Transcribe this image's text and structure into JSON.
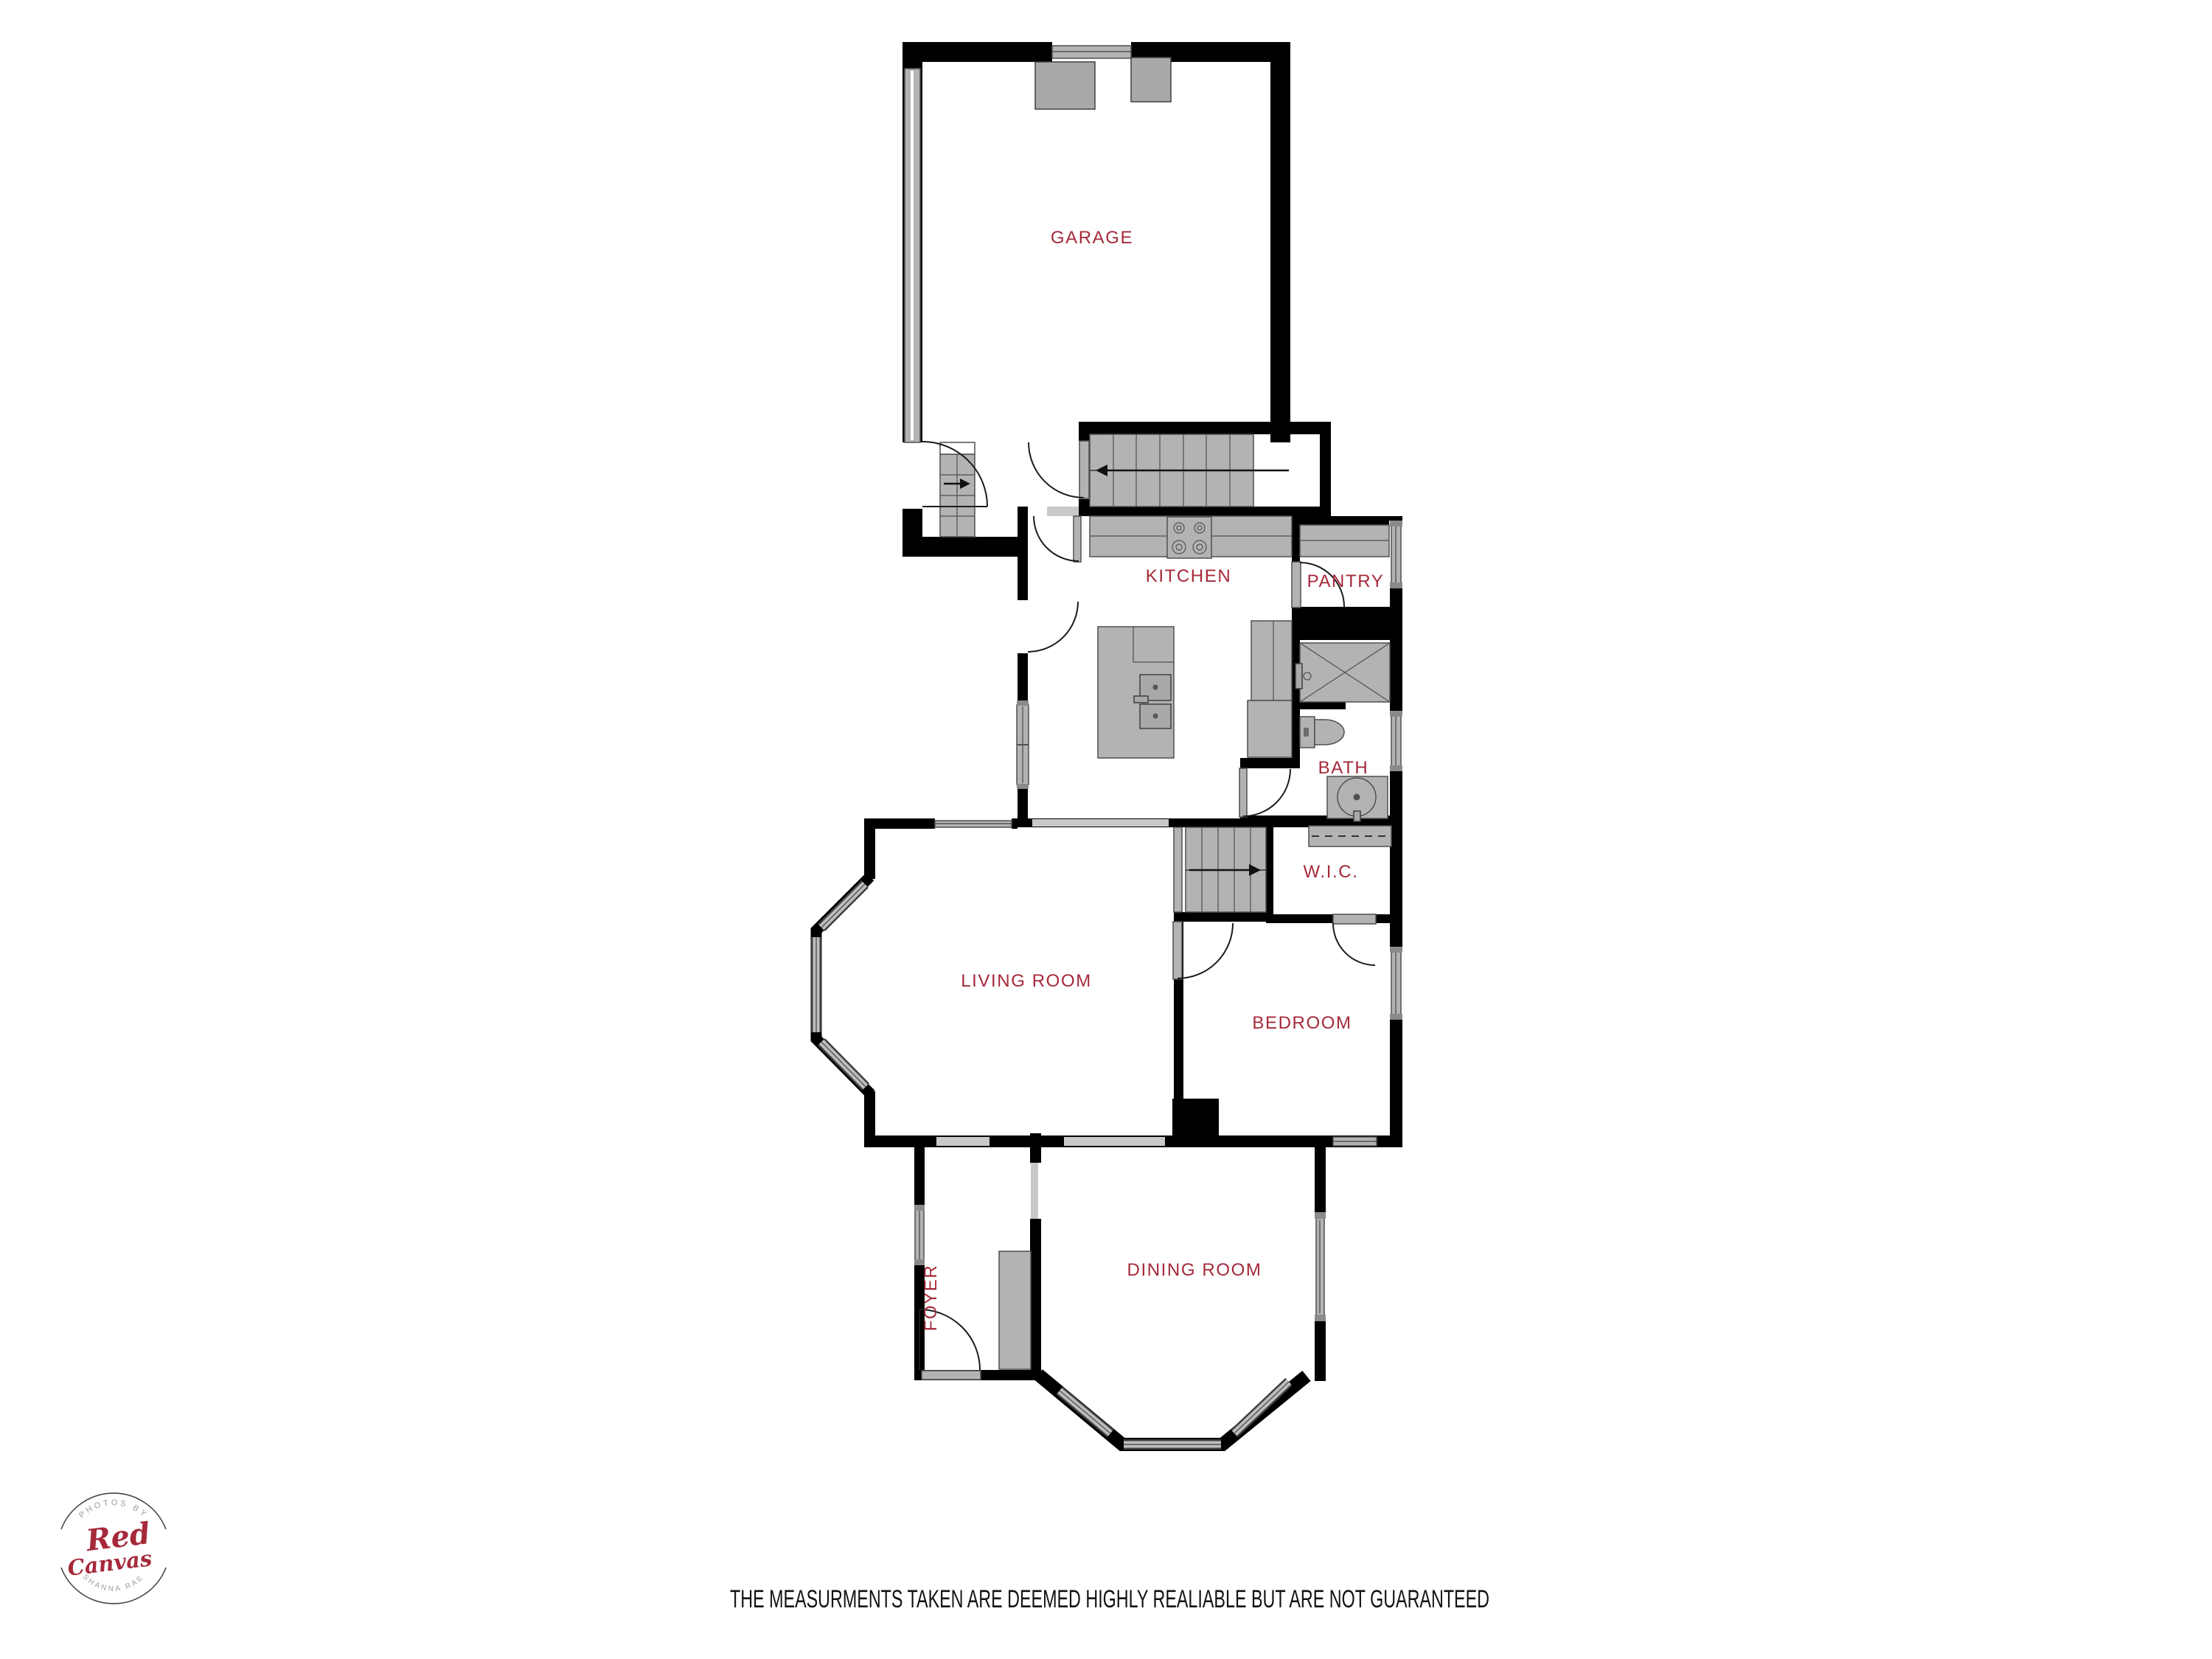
{
  "palette": {
    "wall": "#000000",
    "fixture_fill": "#b3b3b3",
    "fixture_stroke": "#4f4f4f",
    "cased_opening": "#c9c9c9",
    "label_color": "#A5293A",
    "logo_gray": "#9b9b9b",
    "disclaimer_color": "#121212"
  },
  "rooms": {
    "garage": {
      "label": "GARAGE"
    },
    "kitchen": {
      "label": "KITCHEN"
    },
    "pantry": {
      "label": "PANTRY"
    },
    "bath": {
      "label": "BATH"
    },
    "wic": {
      "label": "W.I.C."
    },
    "living": {
      "label": "LIVING ROOM"
    },
    "bedroom": {
      "label": "BEDROOM"
    },
    "foyer": {
      "label": "FOYER"
    },
    "dining": {
      "label": "DINING ROOM"
    }
  },
  "logo": {
    "top_text": "PHOTOS BY",
    "name_line1": "Red",
    "name_line2": "Canvas",
    "bottom_text": "SHANNA RAE"
  },
  "disclaimer": {
    "text": "THE MEASURMENTS TAKEN ARE DEEMED HIGHLY REALIABLE BUT ARE NOT GUARANTEED"
  }
}
